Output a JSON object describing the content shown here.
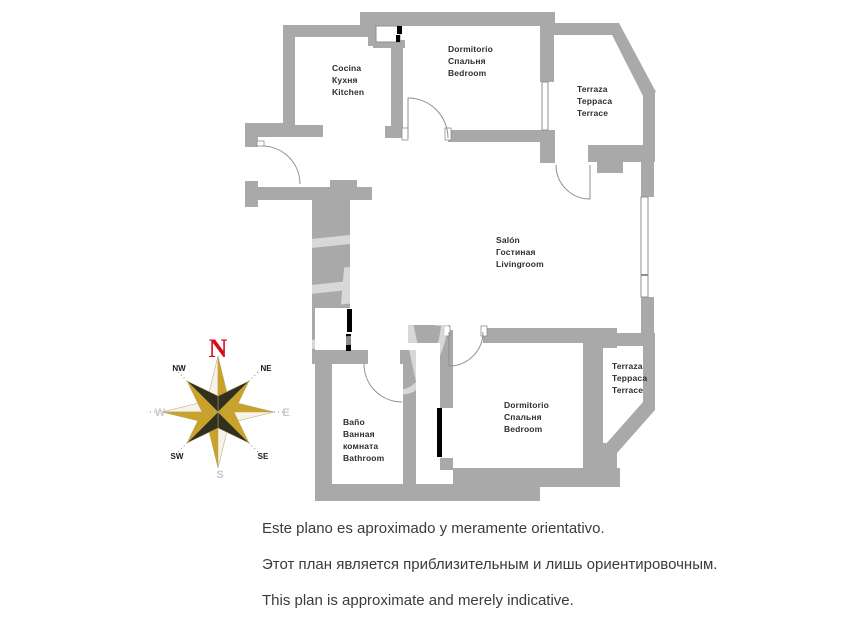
{
  "rooms": {
    "kitchen": {
      "label": "Cocina\nКухня\nKitchen"
    },
    "bedroom_top": {
      "label": "Dormitorio\nСпальня\nBedroom"
    },
    "terrace_top": {
      "label": "Terraza\nТерраса\nTerrace"
    },
    "livingroom": {
      "label": "Salón\nГостиная\nLivingroom"
    },
    "terrace_right": {
      "label": "Terraza\nТерраса\nTerrace"
    },
    "bedroom_bottom": {
      "label": "Dormitorio\nСпальня\nBedroom"
    },
    "bathroom": {
      "label": "Baño\nВанная\nкомната\nBathroom"
    }
  },
  "compass": {
    "n": "N",
    "ne": "NE",
    "e": "E",
    "se": "SE",
    "s": "S",
    "sw": "SW",
    "w": "W",
    "nw": "NW"
  },
  "watermark": {
    "script_letter_1": "E",
    "script_letter_2": "y",
    "caps_text": "PR"
  },
  "disclaimer": {
    "es": "Este plano es aproximado y meramente orientativo.",
    "ru": "Этот план является приблизительным и лишь ориентировочным.",
    "en": "This plan is approximate and merely indicative."
  },
  "colors": {
    "wall_gray": "#a9a9a9",
    "north_red": "#d40e1e",
    "compass_gold": "#c9a227",
    "compass_dark": "#332f1d",
    "compass_cream": "#f7f3e8"
  }
}
